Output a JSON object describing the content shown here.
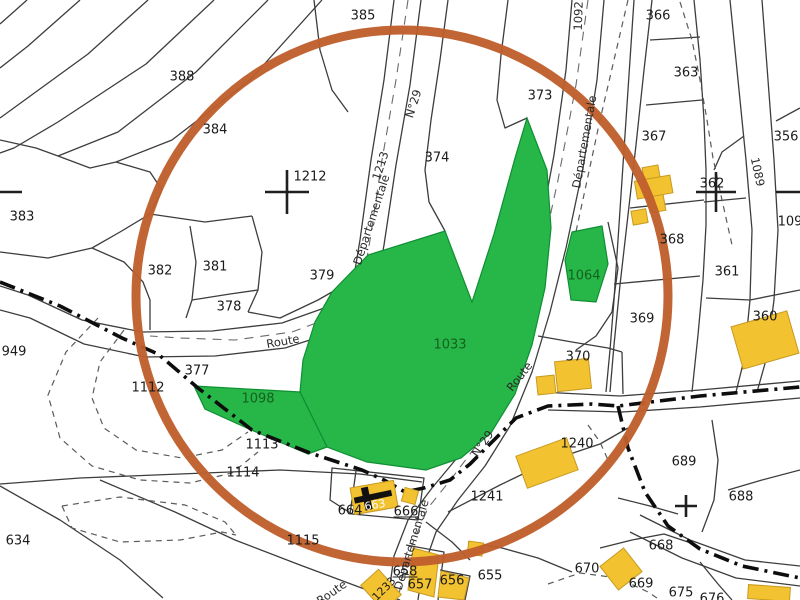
{
  "map": {
    "kind": "cadastral-parcel-map",
    "colors": {
      "background": "#ffffff",
      "parcel_line": "#3d3d3d",
      "annotation_circle": "#c05f2d",
      "selected_parcel_green": "#27b648",
      "building_yellow": "#f2c230",
      "boundary_dashdot": "#0d0d0d",
      "green_label_text": "#14611e"
    },
    "annotation_circle": {
      "cx": 402,
      "cy": 296,
      "r": 266,
      "stroke_width": 9
    },
    "labels": {
      "parcels": [
        {
          "t": "385",
          "x": 363,
          "y": 16
        },
        {
          "t": "388",
          "x": 182,
          "y": 77
        },
        {
          "t": "384",
          "x": 215,
          "y": 130
        },
        {
          "t": "1212",
          "x": 310,
          "y": 177
        },
        {
          "t": "383",
          "x": 22,
          "y": 217
        },
        {
          "t": "382",
          "x": 160,
          "y": 271
        },
        {
          "t": "381",
          "x": 215,
          "y": 267
        },
        {
          "t": "379",
          "x": 322,
          "y": 276
        },
        {
          "t": "378",
          "x": 229,
          "y": 307
        },
        {
          "t": "374",
          "x": 437,
          "y": 158
        },
        {
          "t": "373",
          "x": 540,
          "y": 96
        },
        {
          "t": "366",
          "x": 658,
          "y": 16
        },
        {
          "t": "363",
          "x": 686,
          "y": 73
        },
        {
          "t": "367",
          "x": 654,
          "y": 137
        },
        {
          "t": "356",
          "x": 786,
          "y": 137
        },
        {
          "t": "362",
          "x": 712,
          "y": 184
        },
        {
          "t": "368",
          "x": 672,
          "y": 240
        },
        {
          "t": "361",
          "x": 727,
          "y": 272
        },
        {
          "t": "369",
          "x": 642,
          "y": 319
        },
        {
          "t": "360",
          "x": 765,
          "y": 317
        },
        {
          "t": "370",
          "x": 578,
          "y": 357
        },
        {
          "t": "109",
          "x": 790,
          "y": 222
        },
        {
          "t": "949",
          "x": 14,
          "y": 352
        },
        {
          "t": "377",
          "x": 197,
          "y": 371
        },
        {
          "t": "1112",
          "x": 148,
          "y": 388
        },
        {
          "t": "1113",
          "x": 262,
          "y": 445
        },
        {
          "t": "1114",
          "x": 243,
          "y": 473
        },
        {
          "t": "1115",
          "x": 303,
          "y": 541
        },
        {
          "t": "634",
          "x": 18,
          "y": 541
        },
        {
          "t": "664",
          "x": 350,
          "y": 511
        },
        {
          "t": "666",
          "x": 406,
          "y": 512,
          "u": true
        },
        {
          "t": "1241",
          "x": 487,
          "y": 497
        },
        {
          "t": "1240",
          "x": 577,
          "y": 444
        },
        {
          "t": "689",
          "x": 684,
          "y": 462
        },
        {
          "t": "688",
          "x": 741,
          "y": 497
        },
        {
          "t": "668",
          "x": 661,
          "y": 546
        },
        {
          "t": "670",
          "x": 587,
          "y": 569
        },
        {
          "t": "669",
          "x": 641,
          "y": 584
        },
        {
          "t": "675",
          "x": 681,
          "y": 593
        },
        {
          "t": "676",
          "x": 712,
          "y": 599
        },
        {
          "t": "655",
          "x": 490,
          "y": 576
        },
        {
          "t": "656",
          "x": 452,
          "y": 581
        },
        {
          "t": "657",
          "x": 420,
          "y": 585
        },
        {
          "t": "658",
          "x": 405,
          "y": 572,
          "u": true
        }
      ],
      "green_parcels": [
        {
          "t": "1033",
          "x": 450,
          "y": 345
        },
        {
          "t": "1098",
          "x": 258,
          "y": 399
        },
        {
          "t": "1064",
          "x": 584,
          "y": 276
        }
      ],
      "roads": [
        {
          "t": "N°29",
          "x": 414,
          "y": 104,
          "r": -72
        },
        {
          "t": "1213",
          "x": 381,
          "y": 166,
          "r": -72
        },
        {
          "t": "Départementale",
          "x": 372,
          "y": 220,
          "r": -72
        },
        {
          "t": "1092",
          "x": 579,
          "y": 16,
          "r": -88
        },
        {
          "t": "Départementale",
          "x": 585,
          "y": 142,
          "r": -80
        },
        {
          "t": "1089",
          "x": 757,
          "y": 172,
          "r": 78
        },
        {
          "t": "Route",
          "x": 283,
          "y": 342,
          "r": -10
        },
        {
          "t": "Route",
          "x": 520,
          "y": 377,
          "r": -52
        },
        {
          "t": "N°29",
          "x": 483,
          "y": 444,
          "r": -55
        },
        {
          "t": "Départementale",
          "x": 412,
          "y": 545,
          "r": -73
        },
        {
          "t": "Route",
          "x": 332,
          "y": 593,
          "r": -35
        }
      ],
      "buildings": [
        {
          "t": "663",
          "x": 375,
          "y": 505,
          "r": -10,
          "cls": "bldg-663"
        },
        {
          "t": "1233",
          "x": 384,
          "y": 589,
          "r": -45,
          "cls": "bldg-1233"
        }
      ]
    }
  }
}
